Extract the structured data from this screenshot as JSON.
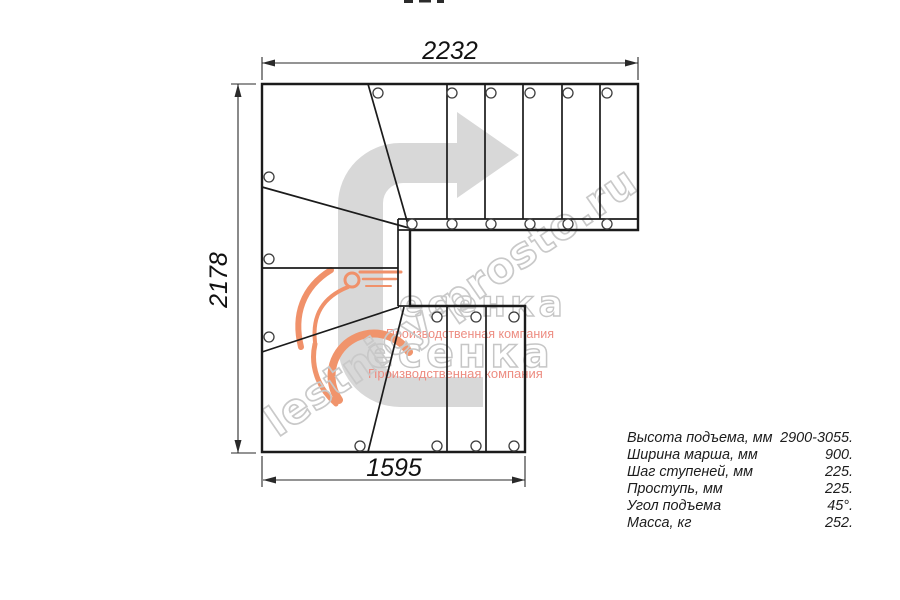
{
  "drawing": {
    "dim_top": "2232",
    "dim_left": "2178",
    "dim_bottom": "1595"
  },
  "watermarks": {
    "diagonal_text": "lestnicy-prosto.ru",
    "logo_text": "есенка",
    "logo_subtitle": "Производственная компания",
    "colors": {
      "outline_gray": "#c9c9c9",
      "flame_orange": "#f0916a",
      "subtitle_pink": "#ed8d82",
      "arrow_gray": "#d8d8d8"
    }
  },
  "specs": {
    "rows": [
      {
        "label": "Высота подъема, мм",
        "value": "2900-3055."
      },
      {
        "label": "Ширина марша, мм",
        "value": "900."
      },
      {
        "label": "Шаг ступеней, мм",
        "value": "225."
      },
      {
        "label": "Проступь, мм",
        "value": "225."
      },
      {
        "label": "Угол подъема",
        "value": "45°."
      },
      {
        "label": "Масса, кг",
        "value": "252."
      }
    ]
  }
}
